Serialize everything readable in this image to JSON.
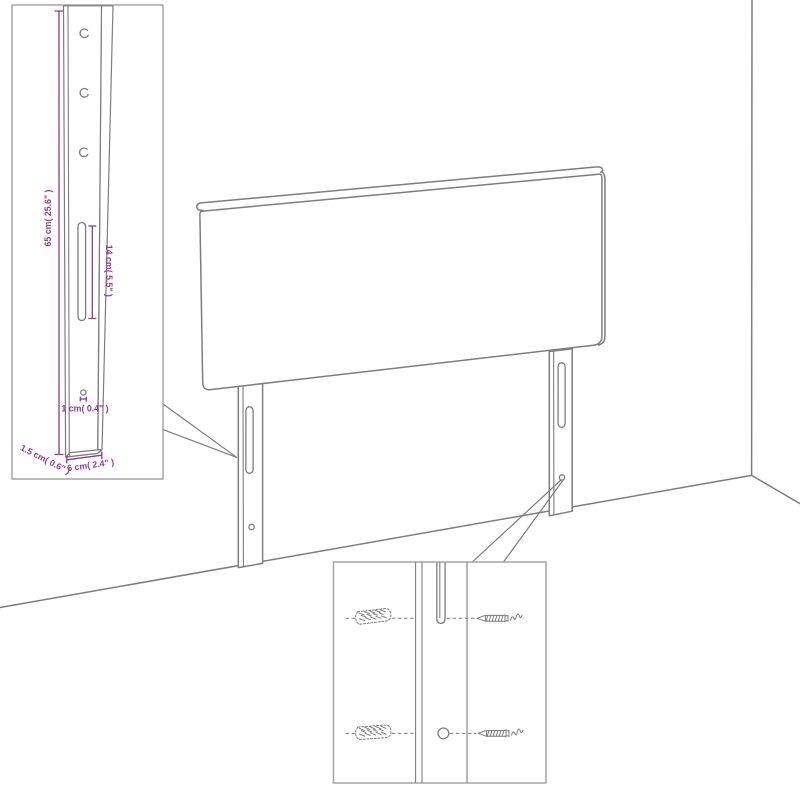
{
  "figure": {
    "background": "#ffffff",
    "colors": {
      "outline": "#7d7d7d",
      "dimension": "#8e3a8e",
      "inset_border": "#9f9f9f"
    },
    "subject": "headboard with two slotted mounting legs shown against a wall corner",
    "dimension_labels": {
      "leg_height": "65 cm( 25.6\" )",
      "slot_length": "14 cm( 5.5\" )",
      "hole_diameter": "1 cm( 0.4\" )",
      "leg_thickness": "1.5 cm( 0.6\" )",
      "leg_width": "6 cm( 2.4\" )"
    },
    "insets": {
      "leg_dimensions": "mounting-leg measurement detail",
      "mounting_hardware": "slot and hole fixing detail with wall plugs and screws"
    }
  }
}
